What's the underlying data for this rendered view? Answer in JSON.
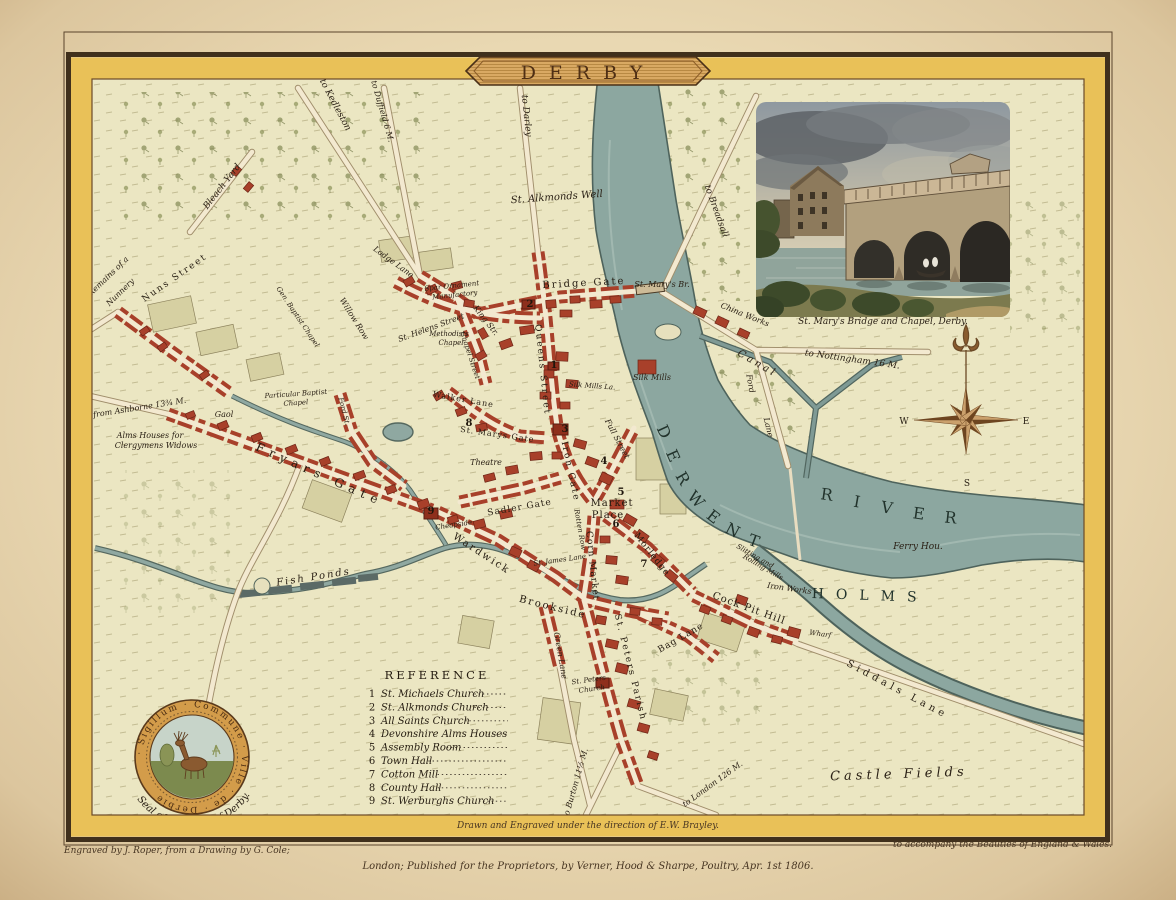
{
  "palette": {
    "paper": "#ead9b4",
    "border_gold": "#e9c158",
    "frame_brown": "#40301c",
    "field": "#ebe6c2",
    "building_red": "#a8402a",
    "water": "#8ca7a0",
    "text_dark": "#2a2015",
    "banner_tan": "#d9a963"
  },
  "title": {
    "text": "DERBY"
  },
  "vignette": {
    "caption": "St. Mary's Bridge and Chapel, Derby."
  },
  "compass": {
    "west": "W",
    "east": "E",
    "south": "S"
  },
  "reference": {
    "title": "REFERENCE",
    "items": [
      {
        "num": "1",
        "label": "St. Michaels Church"
      },
      {
        "num": "2",
        "label": "St. Alkmonds Church"
      },
      {
        "num": "3",
        "label": "All Saints Church"
      },
      {
        "num": "4",
        "label": "Devonshire Alms Houses"
      },
      {
        "num": "5",
        "label": "Assembly Room"
      },
      {
        "num": "6",
        "label": "Town Hall"
      },
      {
        "num": "7",
        "label": "Cotton Mill"
      },
      {
        "num": "8",
        "label": "County Hall"
      },
      {
        "num": "9",
        "label": "St. Werburghs Church"
      }
    ]
  },
  "seal": {
    "ring_text": "· Sigillum · Commune · Ville · de · Derbie",
    "caption": "Seal of the Town of Derby."
  },
  "imprint": {
    "drawn": "Drawn and Engraved under the direction of E.W. Brayley.",
    "engraved": "Engraved by J. Roper, from a Drawing by G. Cole;",
    "published": "London; Published for the Proprietors, by Verner, Hood & Sharpe, Poultry, Apr. 1st 1806.",
    "accompany": "to accompany the Beauties of England & Wales."
  },
  "map": {
    "labels": [
      {
        "t": "to Kedleston",
        "x": 333,
        "y": 106,
        "r": 62,
        "s": 9,
        "c": "i"
      },
      {
        "t": "to Duffield 6 M.",
        "x": 380,
        "y": 112,
        "r": 74,
        "s": 8,
        "c": "i"
      },
      {
        "t": "to Darley",
        "x": 524,
        "y": 116,
        "r": 84,
        "s": 9,
        "c": "i"
      },
      {
        "t": "to Breadsall",
        "x": 714,
        "y": 212,
        "r": 70,
        "s": 9,
        "c": "i"
      },
      {
        "t": "St. Alkmonds Well",
        "x": 557,
        "y": 200,
        "r": -4,
        "s": 10,
        "c": "i"
      },
      {
        "t": "Bleach Yard",
        "x": 224,
        "y": 188,
        "r": -52,
        "s": 9,
        "c": "i"
      },
      {
        "t": "Remains of a",
        "x": 110,
        "y": 278,
        "r": -44,
        "s": 8,
        "c": "i"
      },
      {
        "t": "Nunnery",
        "x": 122,
        "y": 294,
        "r": -44,
        "s": 8,
        "c": "i"
      },
      {
        "t": "Nuns Street",
        "x": 176,
        "y": 280,
        "r": -35,
        "s": 9,
        "c": "s",
        "sp": 2
      },
      {
        "t": "from Ashborne 13¾ M.",
        "x": 140,
        "y": 410,
        "r": -9,
        "s": 8,
        "c": "i"
      },
      {
        "t": "Lodge Lane",
        "x": 392,
        "y": 264,
        "r": 36,
        "s": 8,
        "c": "i"
      },
      {
        "t": "Bridge Gate",
        "x": 584,
        "y": 286,
        "r": -3,
        "s": 10,
        "c": "s",
        "sp": 2
      },
      {
        "t": "St. Mary's Br.",
        "x": 662,
        "y": 287,
        "r": 0,
        "s": 8,
        "c": "i"
      },
      {
        "t": "China Works",
        "x": 744,
        "y": 317,
        "r": 22,
        "s": 8,
        "c": "i"
      },
      {
        "t": "Canal",
        "x": 756,
        "y": 366,
        "r": 30,
        "s": 10,
        "c": "i",
        "sp": 3
      },
      {
        "t": "to Nottingham 16 M.",
        "x": 852,
        "y": 362,
        "r": 8,
        "s": 9,
        "c": "i"
      },
      {
        "t": "Ford",
        "x": 748,
        "y": 384,
        "r": 80,
        "s": 8,
        "c": "i"
      },
      {
        "t": "Lane",
        "x": 766,
        "y": 428,
        "r": 76,
        "s": 8,
        "c": "i"
      },
      {
        "t": "Silk Mills",
        "x": 652,
        "y": 380,
        "r": 0,
        "s": 8,
        "c": "i"
      },
      {
        "t": "Silk Mills La.",
        "x": 592,
        "y": 388,
        "r": 4,
        "s": 7,
        "c": "i"
      },
      {
        "t": "Ferry Hou.",
        "x": 918,
        "y": 549,
        "r": 0,
        "s": 9,
        "c": "i"
      },
      {
        "t": "Iron Works",
        "x": 789,
        "y": 591,
        "r": 8,
        "s": 8,
        "c": "i"
      },
      {
        "t": "Slitting and",
        "x": 754,
        "y": 558,
        "r": 30,
        "s": 7,
        "c": "i"
      },
      {
        "t": "Rolling Mills",
        "x": 762,
        "y": 569,
        "r": 30,
        "s": 7,
        "c": "i"
      },
      {
        "t": "Wharf",
        "x": 820,
        "y": 636,
        "r": 8,
        "s": 7,
        "c": "i"
      },
      {
        "t": "Siddals Lane",
        "x": 896,
        "y": 692,
        "r": 28,
        "s": 10,
        "c": "s",
        "sp": 4
      },
      {
        "t": "Castle Fields",
        "x": 899,
        "y": 778,
        "r": -2,
        "s": 13,
        "c": "f",
        "sp": 4
      },
      {
        "t": "HOLMS",
        "x": 870,
        "y": 600,
        "r": 2,
        "s": 14,
        "c": "r",
        "sp": 12
      },
      {
        "t": "Cock Pit Hill",
        "x": 748,
        "y": 611,
        "r": 20,
        "s": 10,
        "c": "s",
        "sp": 1
      },
      {
        "t": "Market",
        "x": 612,
        "y": 506,
        "r": 0,
        "s": 10,
        "c": "s",
        "sp": 1
      },
      {
        "t": "Place",
        "x": 608,
        "y": 518,
        "r": 0,
        "s": 10,
        "c": "s",
        "sp": 1
      },
      {
        "t": "Corn Market",
        "x": 590,
        "y": 566,
        "r": 84,
        "s": 9,
        "c": "s",
        "sp": 1
      },
      {
        "t": "Morledge",
        "x": 650,
        "y": 556,
        "r": 52,
        "s": 9,
        "c": "s",
        "sp": 1
      },
      {
        "t": "Sadler Gate",
        "x": 520,
        "y": 510,
        "r": -10,
        "s": 9,
        "c": "s",
        "sp": 1
      },
      {
        "t": "Iron Gate",
        "x": 568,
        "y": 472,
        "r": 78,
        "s": 9,
        "c": "s",
        "sp": 2
      },
      {
        "t": "Queens Street",
        "x": 540,
        "y": 370,
        "r": 84,
        "s": 9,
        "c": "s",
        "sp": 2
      },
      {
        "t": "Wardwick",
        "x": 480,
        "y": 556,
        "r": 33,
        "s": 10,
        "c": "s",
        "sp": 2
      },
      {
        "t": "Brookside",
        "x": 552,
        "y": 610,
        "r": 14,
        "s": 10,
        "c": "s",
        "sp": 2
      },
      {
        "t": "Green Lane",
        "x": 558,
        "y": 656,
        "r": 80,
        "s": 8,
        "c": "i"
      },
      {
        "t": "St. Peters Parish",
        "x": 628,
        "y": 668,
        "r": 76,
        "s": 9,
        "c": "s",
        "sp": 2
      },
      {
        "t": "St. Peters",
        "x": 589,
        "y": 682,
        "r": -8,
        "s": 7,
        "c": "i"
      },
      {
        "t": "Church",
        "x": 592,
        "y": 691,
        "r": -8,
        "s": 7,
        "c": "i"
      },
      {
        "t": "Bag Lane",
        "x": 682,
        "y": 640,
        "r": -30,
        "s": 9,
        "c": "s",
        "sp": 1
      },
      {
        "t": "to Burton 11½ M.",
        "x": 578,
        "y": 784,
        "r": -74,
        "s": 8,
        "c": "i"
      },
      {
        "t": "to London 126 M.",
        "x": 714,
        "y": 786,
        "r": -36,
        "s": 8,
        "c": "i"
      },
      {
        "t": "Fryars Gate",
        "x": 318,
        "y": 478,
        "r": 24,
        "s": 12,
        "c": "s",
        "sp": 6
      },
      {
        "t": "Alms Houses for",
        "x": 150,
        "y": 438,
        "r": 0,
        "s": 8,
        "c": "i"
      },
      {
        "t": "Clergymens Widows",
        "x": 156,
        "y": 448,
        "r": 0,
        "s": 8,
        "c": "i"
      },
      {
        "t": "Gaol",
        "x": 224,
        "y": 417,
        "r": 0,
        "s": 8,
        "c": "i"
      },
      {
        "t": "Fish Ponds",
        "x": 314,
        "y": 580,
        "r": -9,
        "s": 10,
        "c": "i",
        "sp": 2
      },
      {
        "t": "St. Helens Street",
        "x": 432,
        "y": 330,
        "r": -20,
        "s": 8,
        "c": "i"
      },
      {
        "t": "Spar Ornament",
        "x": 452,
        "y": 288,
        "r": -6,
        "s": 7,
        "c": "i"
      },
      {
        "t": "Manufactory",
        "x": 455,
        "y": 297,
        "r": -6,
        "s": 7,
        "c": "i"
      },
      {
        "t": "Methodists",
        "x": 449,
        "y": 336,
        "r": 0,
        "s": 7,
        "c": "i"
      },
      {
        "t": "Chapel",
        "x": 451,
        "y": 345,
        "r": 0,
        "s": 7,
        "c": "i"
      },
      {
        "t": "Walker Lane",
        "x": 463,
        "y": 402,
        "r": 10,
        "s": 8,
        "c": "s",
        "sp": 1
      },
      {
        "t": "King Str.",
        "x": 484,
        "y": 322,
        "r": 52,
        "s": 8,
        "c": "i"
      },
      {
        "t": "Chapel Street",
        "x": 468,
        "y": 356,
        "r": 72,
        "s": 7,
        "c": "i"
      },
      {
        "t": "Particular Baptist",
        "x": 296,
        "y": 396,
        "r": -4,
        "s": 7,
        "c": "i"
      },
      {
        "t": "Chapel",
        "x": 296,
        "y": 405,
        "r": -4,
        "s": 7,
        "c": "i"
      },
      {
        "t": "Gen. Baptist Chapel",
        "x": 296,
        "y": 318,
        "r": 56,
        "s": 7,
        "c": "i"
      },
      {
        "t": "Ford St.",
        "x": 342,
        "y": 412,
        "r": 76,
        "s": 7,
        "c": "i"
      },
      {
        "t": "Willow Row",
        "x": 352,
        "y": 320,
        "r": 58,
        "s": 8,
        "c": "i"
      },
      {
        "t": "St. Marys Gate",
        "x": 497,
        "y": 437,
        "r": 8,
        "s": 8,
        "c": "s",
        "sp": 1
      },
      {
        "t": "Theatre",
        "x": 486,
        "y": 465,
        "r": 0,
        "s": 8,
        "c": "i"
      },
      {
        "t": "Cheapside",
        "x": 454,
        "y": 527,
        "r": -8,
        "s": 7,
        "c": "i"
      },
      {
        "t": "St. James Lane",
        "x": 560,
        "y": 562,
        "r": -8,
        "s": 7,
        "c": "i"
      },
      {
        "t": "Rotten Row",
        "x": 578,
        "y": 530,
        "r": 80,
        "s": 7,
        "c": "i"
      },
      {
        "t": "Full Street",
        "x": 615,
        "y": 440,
        "r": 62,
        "s": 8,
        "c": "i"
      },
      {
        "t": "1",
        "x": 554,
        "y": 368,
        "r": 0,
        "s": 10,
        "c": "n"
      },
      {
        "t": "2",
        "x": 530,
        "y": 307,
        "r": 0,
        "s": 10,
        "c": "n"
      },
      {
        "t": "3",
        "x": 565,
        "y": 432,
        "r": 0,
        "s": 10,
        "c": "n"
      },
      {
        "t": "4",
        "x": 604,
        "y": 464,
        "r": 0,
        "s": 10,
        "c": "n"
      },
      {
        "t": "5",
        "x": 621,
        "y": 495,
        "r": 0,
        "s": 10,
        "c": "n"
      },
      {
        "t": "6",
        "x": 616,
        "y": 527,
        "r": 0,
        "s": 10,
        "c": "n"
      },
      {
        "t": "7",
        "x": 644,
        "y": 567,
        "r": 0,
        "s": 10,
        "c": "n"
      },
      {
        "t": "8",
        "x": 469,
        "y": 426,
        "r": 0,
        "s": 10,
        "c": "n"
      },
      {
        "t": "9",
        "x": 431,
        "y": 514,
        "r": 0,
        "s": 10,
        "c": "n"
      },
      {
        "t": "D",
        "x": 659,
        "y": 434,
        "r": 65,
        "s": 16,
        "c": "r"
      },
      {
        "t": "E",
        "x": 668,
        "y": 458,
        "r": 66,
        "s": 16,
        "c": "r"
      },
      {
        "t": "R",
        "x": 678,
        "y": 481,
        "r": 60,
        "s": 16,
        "c": "r"
      },
      {
        "t": "W",
        "x": 692,
        "y": 503,
        "r": 48,
        "s": 16,
        "c": "r"
      },
      {
        "t": "E",
        "x": 710,
        "y": 521,
        "r": 38,
        "s": 16,
        "c": "r"
      },
      {
        "t": "N",
        "x": 730,
        "y": 535,
        "r": 28,
        "s": 16,
        "c": "r"
      },
      {
        "t": "T",
        "x": 752,
        "y": 546,
        "r": 20,
        "s": 16,
        "c": "r"
      },
      {
        "t": "R",
        "x": 826,
        "y": 500,
        "r": 8,
        "s": 16,
        "c": "r"
      },
      {
        "t": "I",
        "x": 856,
        "y": 507,
        "r": 10,
        "s": 16,
        "c": "r"
      },
      {
        "t": "V",
        "x": 886,
        "y": 513,
        "r": 10,
        "s": 16,
        "c": "r"
      },
      {
        "t": "E",
        "x": 918,
        "y": 519,
        "r": 8,
        "s": 16,
        "c": "r"
      },
      {
        "t": "R",
        "x": 950,
        "y": 523,
        "r": 6,
        "s": 16,
        "c": "r"
      }
    ]
  }
}
